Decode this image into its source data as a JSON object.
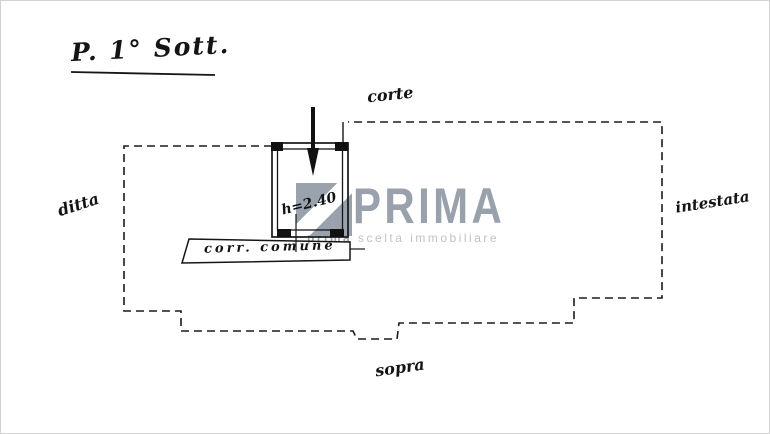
{
  "plan": {
    "title": "P. 1° Sott.",
    "labels": {
      "corte": "corte",
      "ditta": "ditta",
      "intestata": "intestata",
      "sopra": "sopra",
      "corridor": "corr. comune",
      "room_height": "h=2.40"
    },
    "ink_color": "#161616"
  },
  "watermark": {
    "brand": "PRIMA",
    "tagline_bold": "prima",
    "tagline_rest": "scelta immobiliare",
    "logo_color": "#9aa3ad",
    "brand_color": "#99a1ac",
    "tagline_color": "#bdc3cb"
  }
}
